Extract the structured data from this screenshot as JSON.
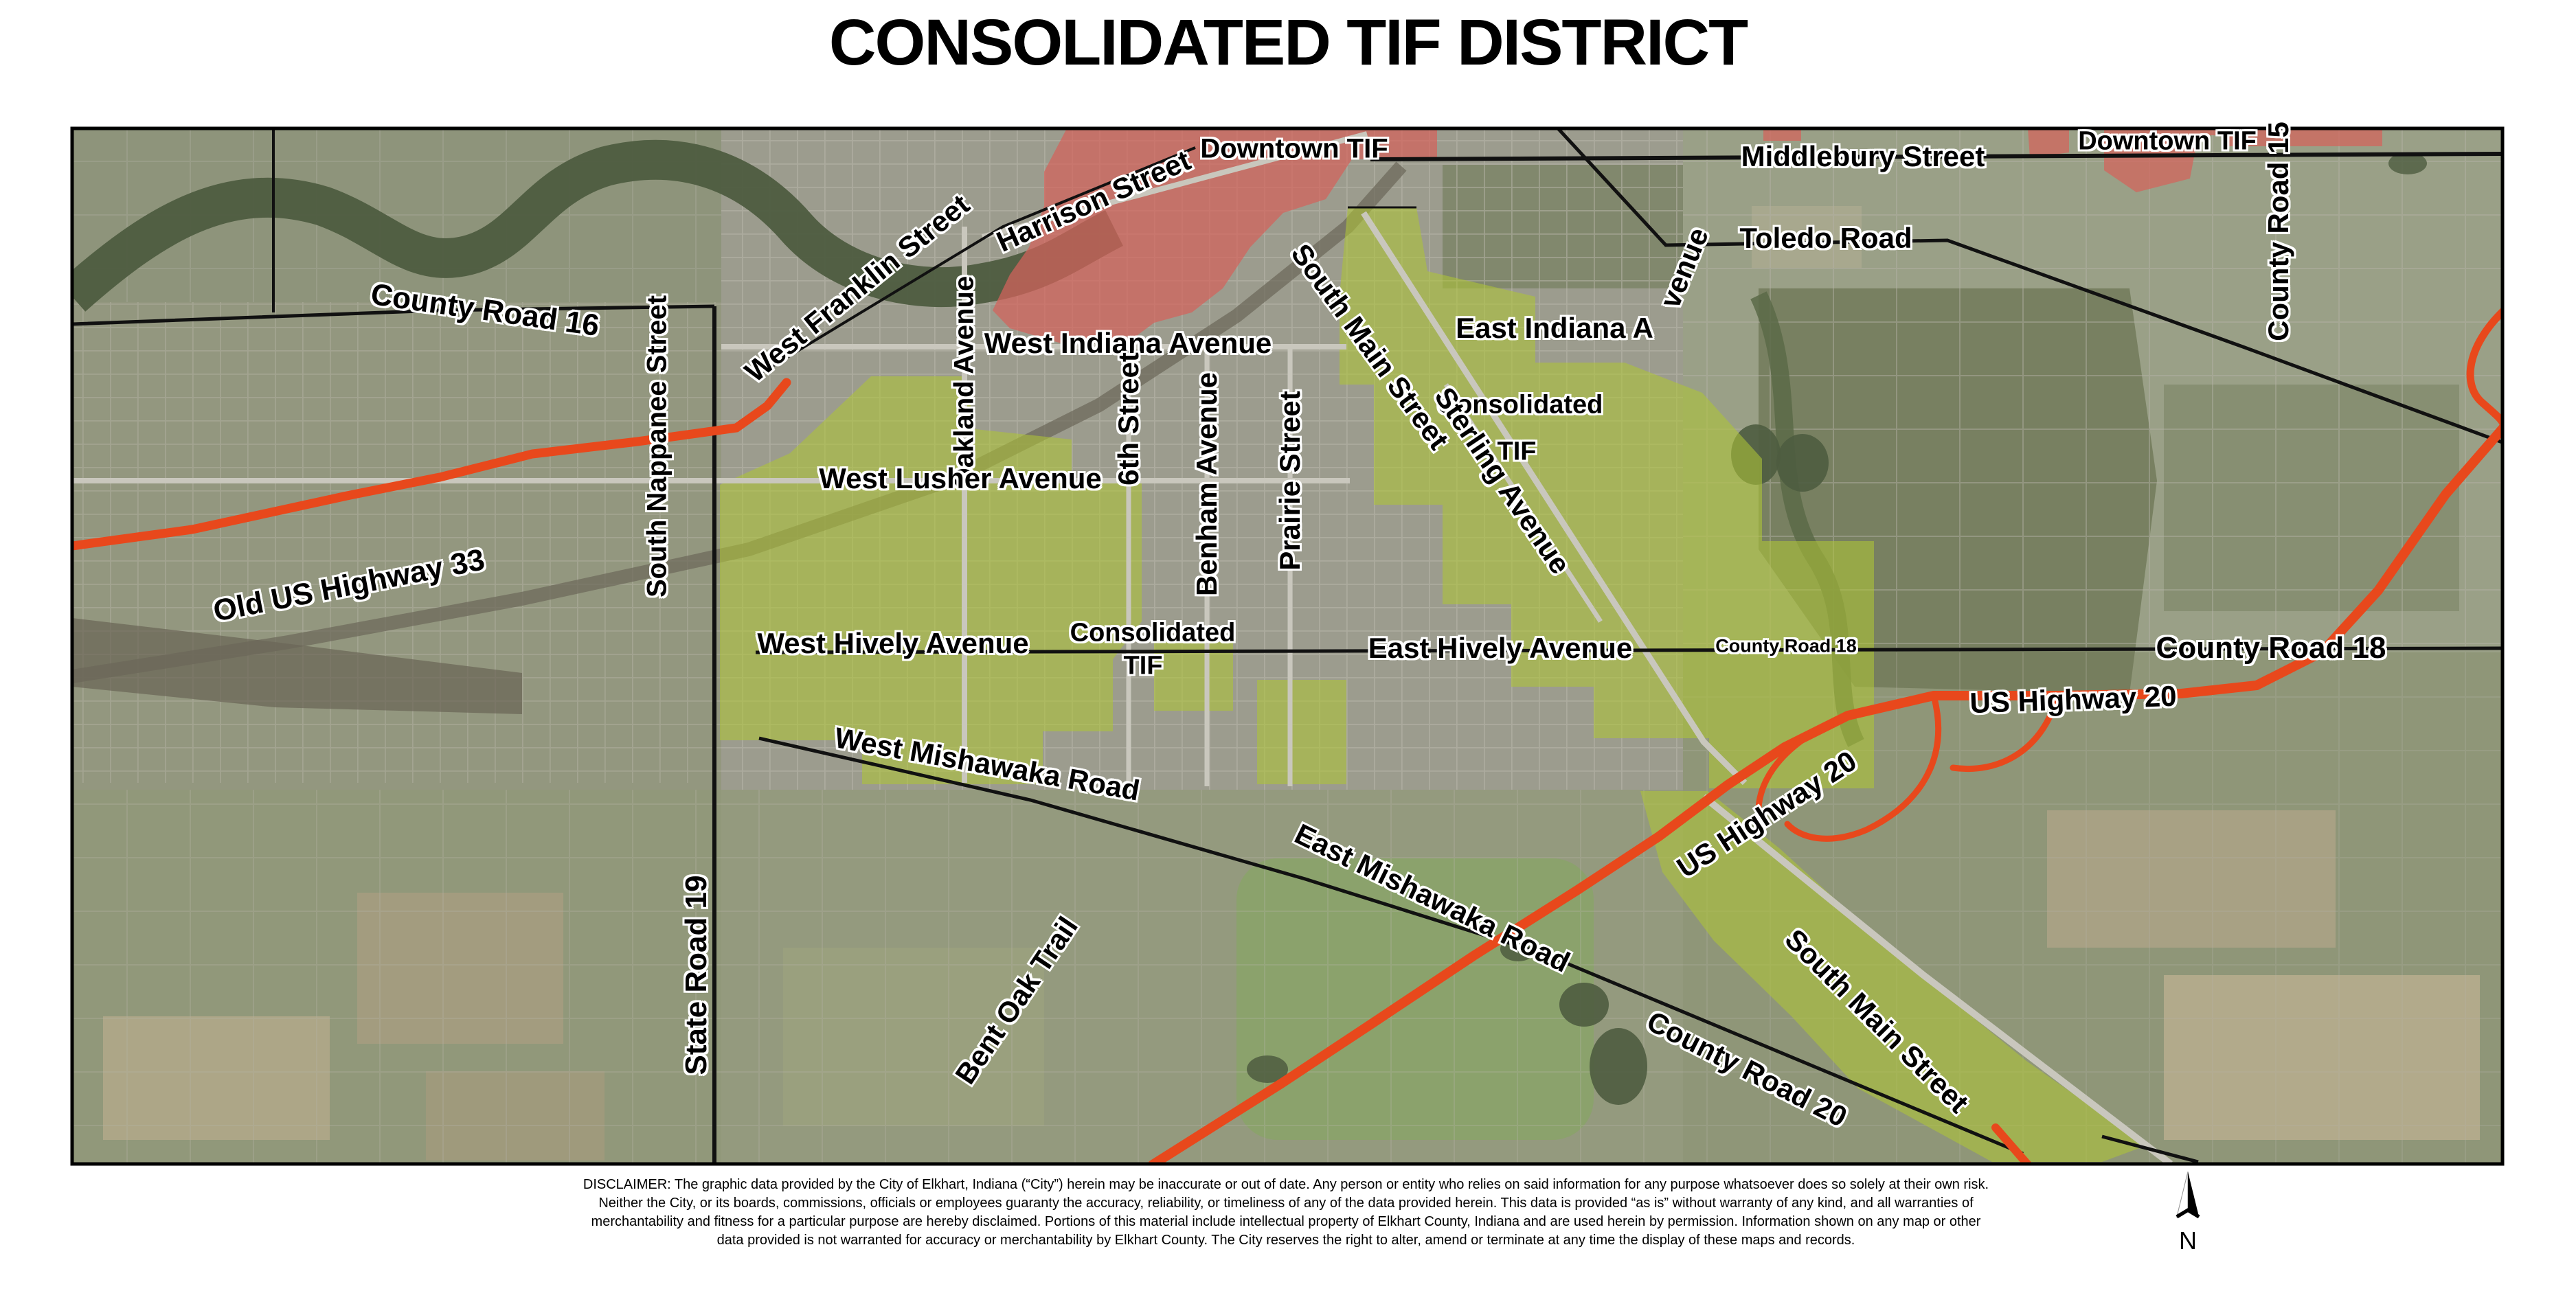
{
  "title": "CONSOLIDATED TIF DISTRICT",
  "colors": {
    "tif_green": "#aec437",
    "downtown_red": "#d4625c",
    "highway_orange": "#e8481c",
    "road_black": "#111111",
    "road_gray": "#c9c7bd",
    "water": "#4e5c40"
  },
  "labels": {
    "county_road_16": {
      "text": "County Road 16"
    },
    "old_us_highway_33": {
      "text": "Old US Highway 33"
    },
    "south_nappanee_street": {
      "text": "South Nappanee Street"
    },
    "west_franklin_street": {
      "text": "West Franklin Street"
    },
    "harrison_street": {
      "text": "Harrison Street"
    },
    "downtown_tif_west": {
      "text": "Downtown TIF"
    },
    "oakland_avenue": {
      "text": "Oakland Avenue"
    },
    "west_indiana_avenue": {
      "text": "West Indiana Avenue"
    },
    "south_main_street_north": {
      "text": "South Main Street"
    },
    "east_indiana_avenue": {
      "text": "East Indiana A"
    },
    "east_indiana_avenue_tail": {
      "text": "venue"
    },
    "consolidated_tif_north_line1": {
      "text": "Consolidated"
    },
    "consolidated_tif_north_line2": {
      "text": "TIF"
    },
    "sterling_avenue": {
      "text": "Sterling Avenue"
    },
    "sixth_street": {
      "text": "6th Street"
    },
    "benham_avenue": {
      "text": "Benham Avenue"
    },
    "prairie_street": {
      "text": "Prairie Street"
    },
    "west_lusher_avenue": {
      "text": "West Lusher Avenue"
    },
    "middlebury_street": {
      "text": "Middlebury Street"
    },
    "downtown_tif_east": {
      "text": "Downtown TIF"
    },
    "toledo_road": {
      "text": "Toledo Road"
    },
    "county_road_15": {
      "text": "County Road 15"
    },
    "west_hively_avenue": {
      "text": "West Hively Avenue"
    },
    "consolidated_tif_south_line1": {
      "text": "Consolidated"
    },
    "consolidated_tif_south_line2": {
      "text": "TIF"
    },
    "east_hively_avenue": {
      "text": "East Hively Avenue"
    },
    "county_road_18_small": {
      "text": "County Road 18"
    },
    "us_highway_20_east": {
      "text": "US Highway 20"
    },
    "county_road_18_large": {
      "text": "County Road 18"
    },
    "west_mishawaka_road": {
      "text": "West Mishawaka Road"
    },
    "east_mishawaka_road": {
      "text": "East Mishawaka Road"
    },
    "us_highway_20_diagonal": {
      "text": "US Highway 20"
    },
    "state_road_19": {
      "text": "State Road 19"
    },
    "bent_oak_trail": {
      "text": "Bent Oak Trail"
    },
    "south_main_street_south": {
      "text": "South Main Street"
    },
    "county_road_20": {
      "text": "County Road 20"
    }
  },
  "north_arrow": {
    "label": "N"
  },
  "disclaimer": {
    "lines": [
      "DISCLAIMER: The graphic data provided by the City of Elkhart, Indiana (“City”) herein may be inaccurate or out of date. Any person or entity who relies on said information for any purpose whatsoever does so solely at their own risk.",
      "Neither the City, or its boards, commissions, officials or employees guaranty the accuracy, reliability, or timeliness of any of the data provided herein. This data is provided “as is” without warranty of any kind, and all warranties of",
      "merchantability and fitness for a particular purpose are hereby disclaimed. Portions of this material include intellectual property of Elkhart County, Indiana and are used herein by permission. Information shown on any map or other",
      "data provided is not warranted for accuracy or merchantability by Elkhart County. The City reserves the right to alter, amend or terminate at any time the display of these maps and records."
    ]
  }
}
